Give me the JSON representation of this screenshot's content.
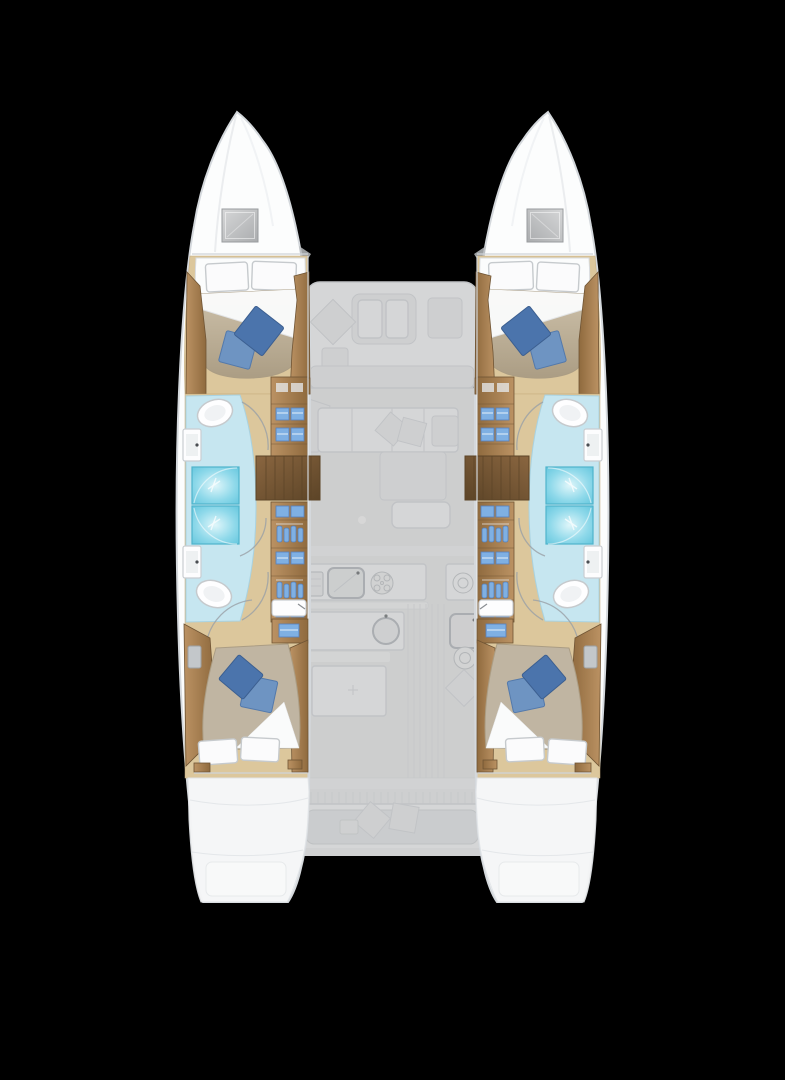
{
  "scene": {
    "type": "catamaran-floorplan-top-view",
    "view": "interior deck plan, bow up, twin hulls with ghosted central saloon and decks"
  },
  "colors": {
    "background": "#000000",
    "hull_fill": "#fcfdfd",
    "hull_stroke": "#d4d8dc",
    "wall_line": "#d0d4d8",
    "sheer_line": "#e6e9eb",
    "floor_wood": "#dcc79c",
    "floor_wood_edge": "#c6ac7e",
    "wood_light": "#bb9263",
    "wood_dark": "#8f6a3e",
    "wood_stroke": "#6f5434",
    "wood_step_light": "#8a6640",
    "wood_step_dark": "#5c4427",
    "mattress": "#cec2ab",
    "mattress_shadow": "#ab9d84",
    "mattress_aft": "#c0b5a2",
    "linen": "#fbfbfc",
    "linen_stroke": "#c6cacd",
    "pillow_dark": "#4b74ac",
    "pillow_dark_edge": "#3c5f90",
    "pillow_mid": "#6e94c2",
    "pillow_mid_edge": "#5379ab",
    "bath_floor": "#c6e6f0",
    "bath_floor_stroke": "#a9d2e0",
    "shower_core": "#dff6fa",
    "shower_mid": "#8fd9ea",
    "shower_edge": "#5fc4dc",
    "shower_stroke": "#4fb3cb",
    "fixture": "#fdfdfe",
    "fixture_stroke": "#c9cdd1",
    "fixture_bowl": "#eef1f2",
    "faucet": "#4a4e52",
    "door_arc": "#9aa0a6",
    "item_blue": "#7fb0e3",
    "item_blue_dark": "#5580bc",
    "hatch_light": "#d6d7d8",
    "hatch_dark": "#aaacae",
    "hatch_stroke": "#999c9e",
    "ghost_floor": "#f1f2f3",
    "ghost_white": "#fbfcfd",
    "ghost_fill": "#f3f4f5",
    "ghost_stroke": "#e3e6e9",
    "ghost_line": "#eaecee",
    "metal_gray": "#b9bcbe"
  },
  "inventory": {
    "hulls": 2,
    "bow_deck_hatches": 2,
    "guest_cabins": 4,
    "double_berths": 4,
    "white_pillows": 8,
    "blue_throw_pillows": 8,
    "bathrooms": 4,
    "toilets": 4,
    "shower_stalls": 4,
    "vanity_sinks": 4,
    "aft_hull_sinks": 2,
    "wardrobe_columns": 4,
    "companionway_stairs": 2,
    "saloon": 1,
    "saloon_sofa": 1,
    "saloon_table": 1,
    "galley_sinks": 3,
    "galley_burner_circles": 3,
    "forward_cockpit_table": 1,
    "aft_cockpit_bench": 1,
    "transom_platforms": 2
  }
}
